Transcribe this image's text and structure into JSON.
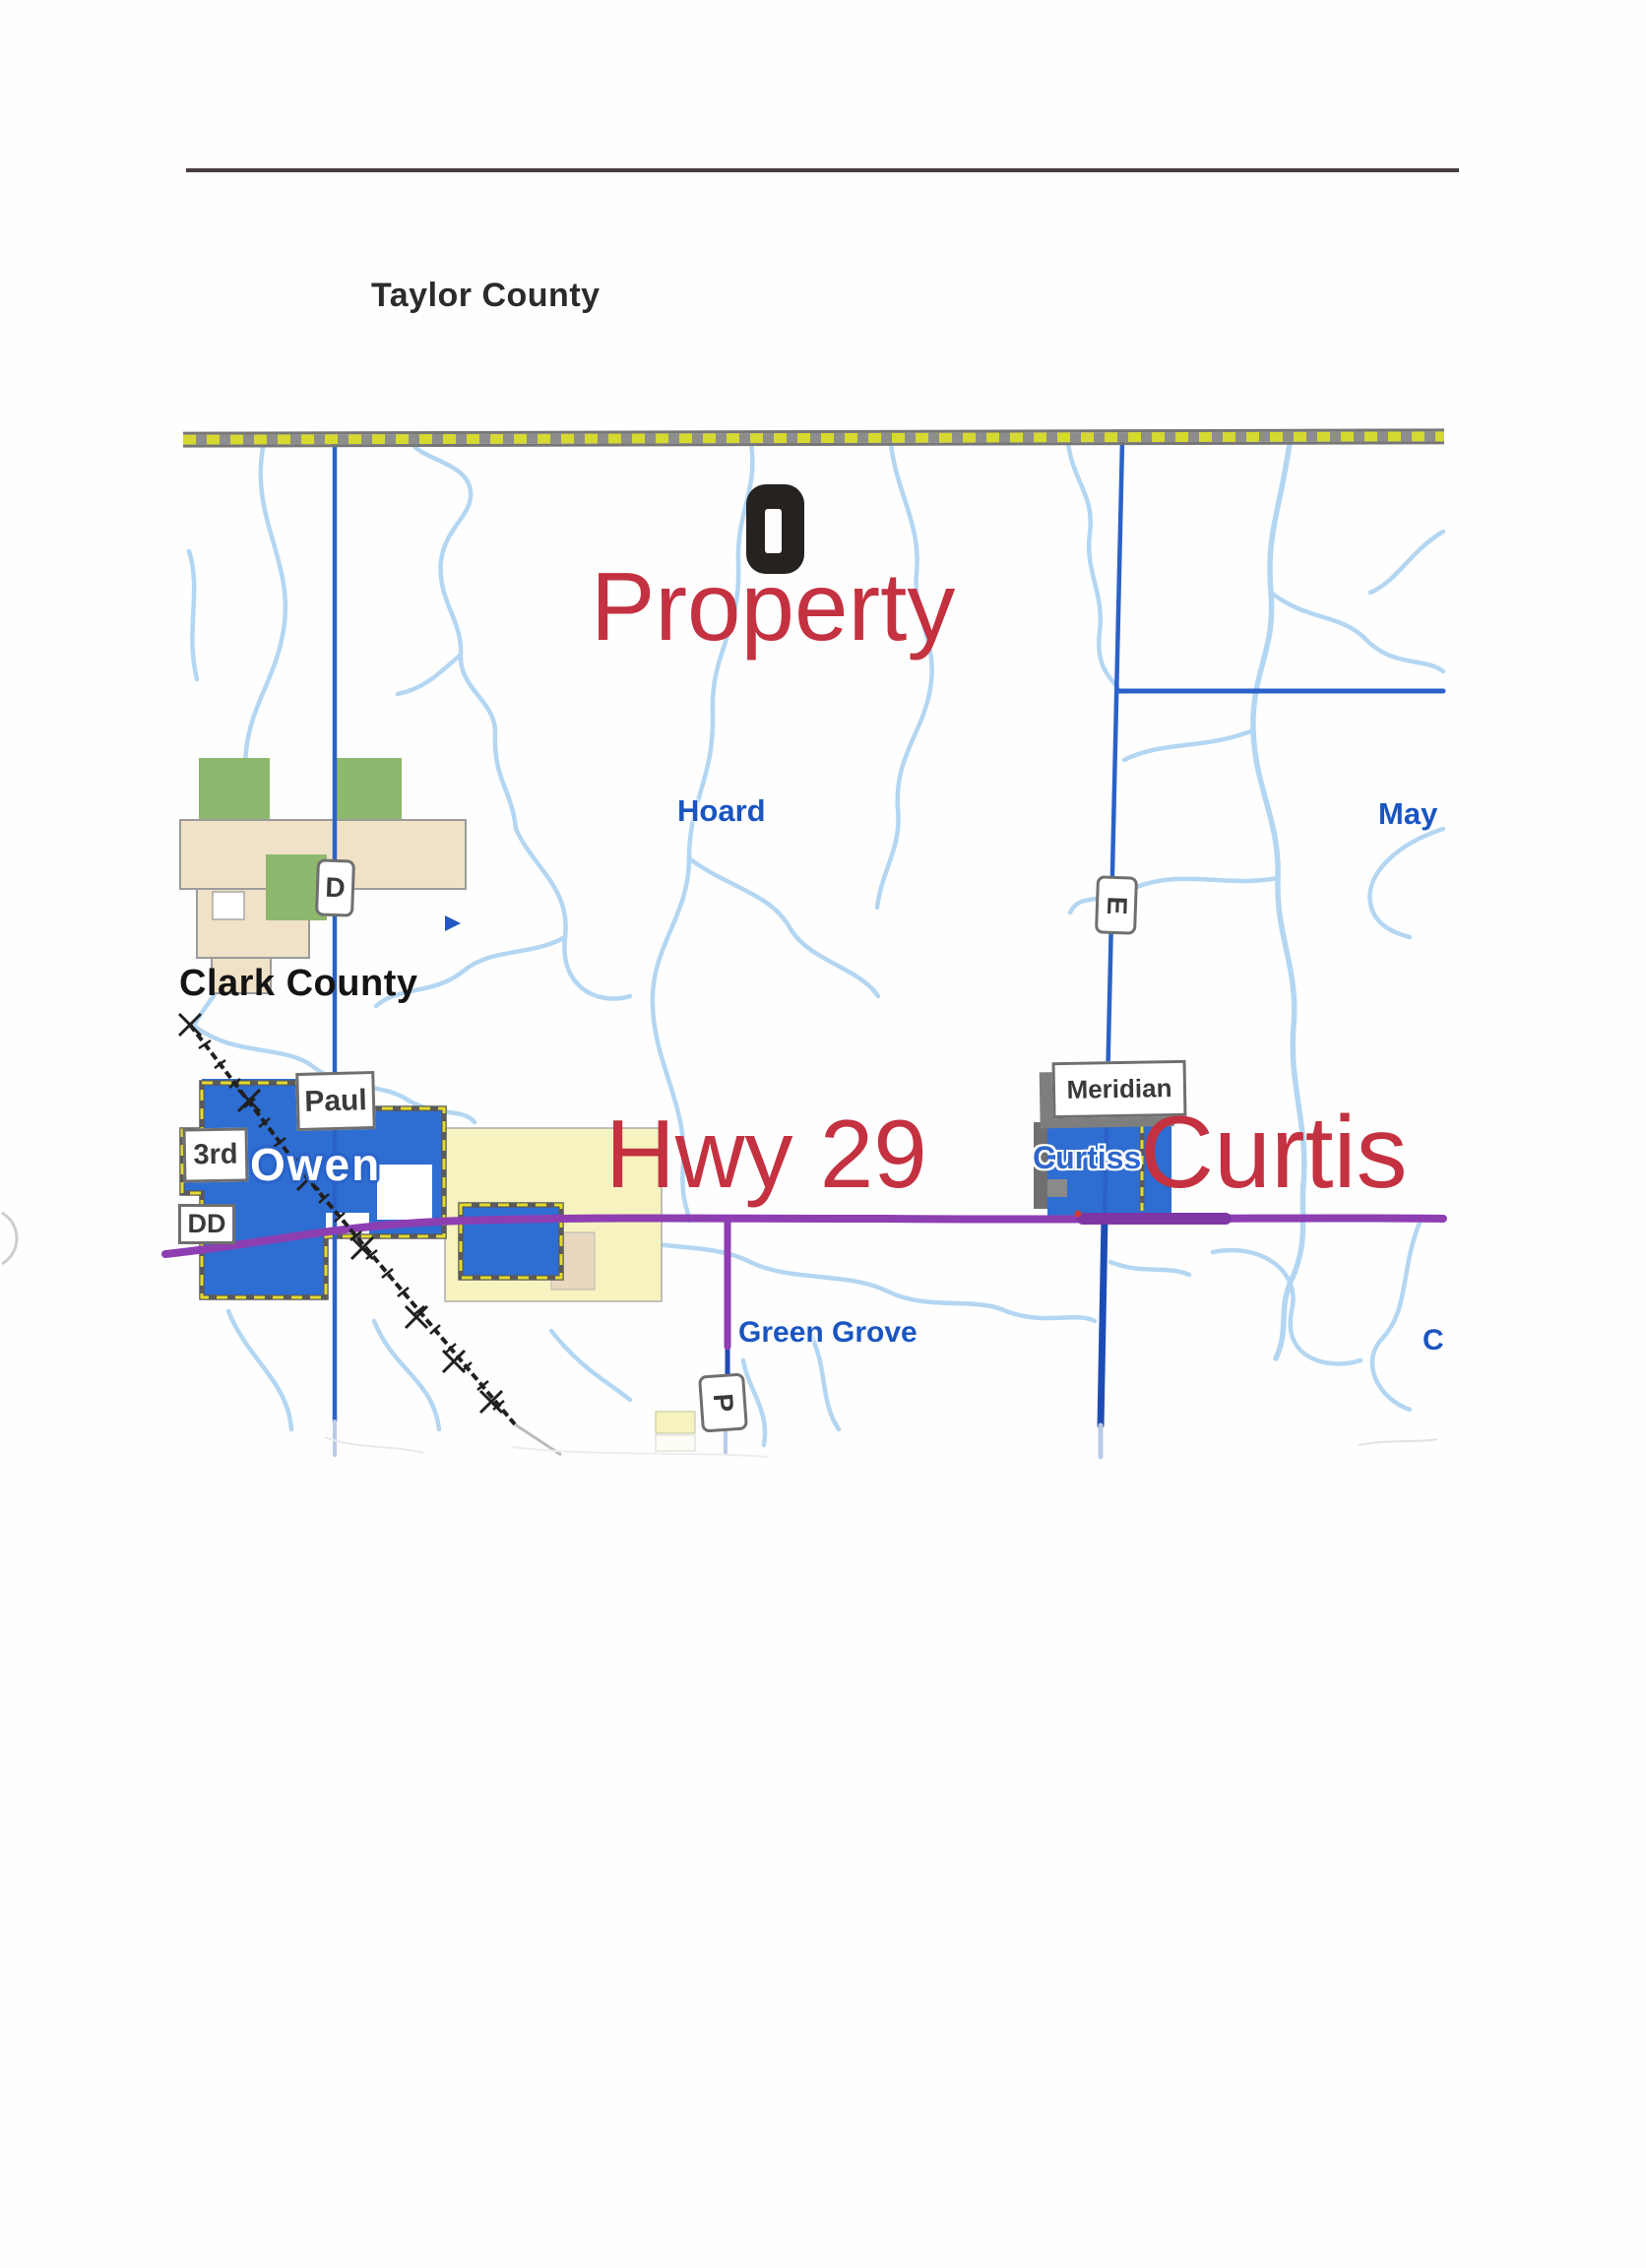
{
  "page": {
    "heading": "Taylor County"
  },
  "map": {
    "county_labels": {
      "clark": "Clark County"
    },
    "red_annotations": {
      "property": "Property",
      "hwy29": "Hwy 29",
      "curtis": "Curtis"
    },
    "town_labels": {
      "hoard": "Hoard",
      "may": "May",
      "green_grove": "Green Grove",
      "curtiss": "Curtiss",
      "owen": "Owen",
      "partial_c": "C"
    },
    "road_shields": {
      "d": "D",
      "e": "E",
      "p": "P"
    },
    "street_boxes": {
      "paul": "Paul",
      "third": "3rd",
      "dd": "DD",
      "meridian": "Meridian"
    },
    "colors": {
      "annotation_red": "#c43140",
      "road_blue": "#2b62c8",
      "road_navy": "#1e4cb5",
      "river_blue": "#b3d6f2",
      "highway_purple": "#8d3fb2",
      "city_blue": "#2e6dd2",
      "boundary_dash_yellow": "#e3da2c",
      "county_dash_yellow": "#d6d92f",
      "town_label_blue": "#1a55c0",
      "forest_green": "#8eb86d",
      "public_land_tan": "#f0e2c6",
      "town_area_yellow": "#f6f3c0",
      "marker_black": "#262220"
    }
  }
}
